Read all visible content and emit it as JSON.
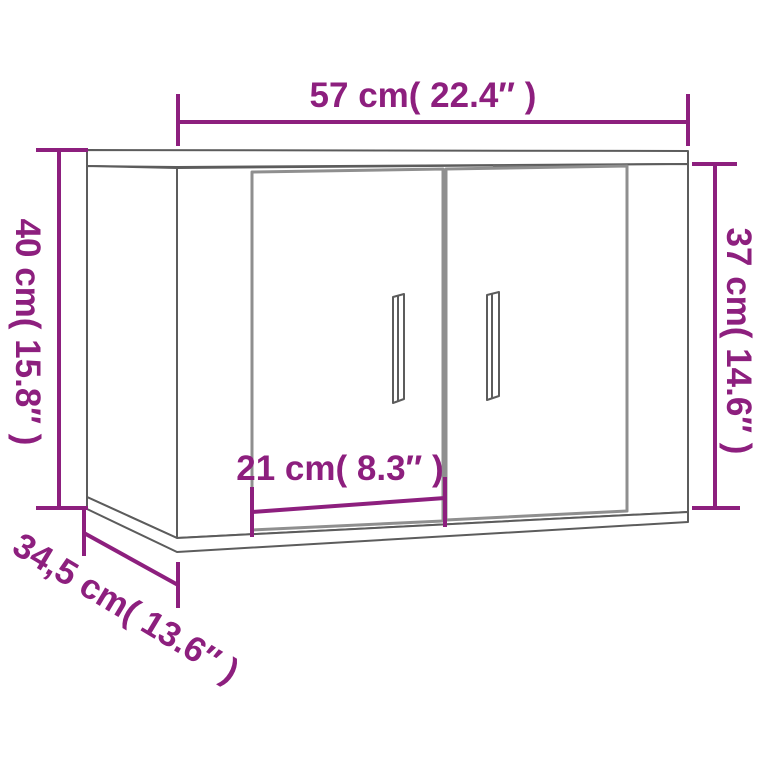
{
  "page": {
    "description": "Product dimension diagram of a wall-mounted cabinet with two doors",
    "background_color": "#ffffff"
  },
  "colors": {
    "dimension": "#8D1F7E",
    "outline": "#5C5C5C",
    "door_outline": "#8F8F8F",
    "rail": "#6A6A6A",
    "panel_fill": "#FFFFFF"
  },
  "dimensions": {
    "width": {
      "label": "57 cm( 22.4″ )",
      "cm": "57",
      "inch": "22.4"
    },
    "height_left": {
      "label": "40 cm( 15.8″ )",
      "cm": "40",
      "inch": "15.8"
    },
    "height_right": {
      "label": "37 cm( 14.6″ )",
      "cm": "37",
      "inch": "14.6"
    },
    "door_width": {
      "label": "21 cm( 8.3″ )",
      "cm": "21",
      "inch": "8.3"
    },
    "depth": {
      "label": "34,5 cm( 13.6″ )",
      "cm": "34,5",
      "inch": "13.6"
    }
  },
  "object": {
    "name": "wall cabinet with two doors",
    "parts": [
      "top-panel",
      "left-side-panel",
      "front-panel",
      "bottom-panel",
      "left-door",
      "right-door",
      "left-door-handle",
      "right-door-handle",
      "mounting-rail"
    ]
  }
}
